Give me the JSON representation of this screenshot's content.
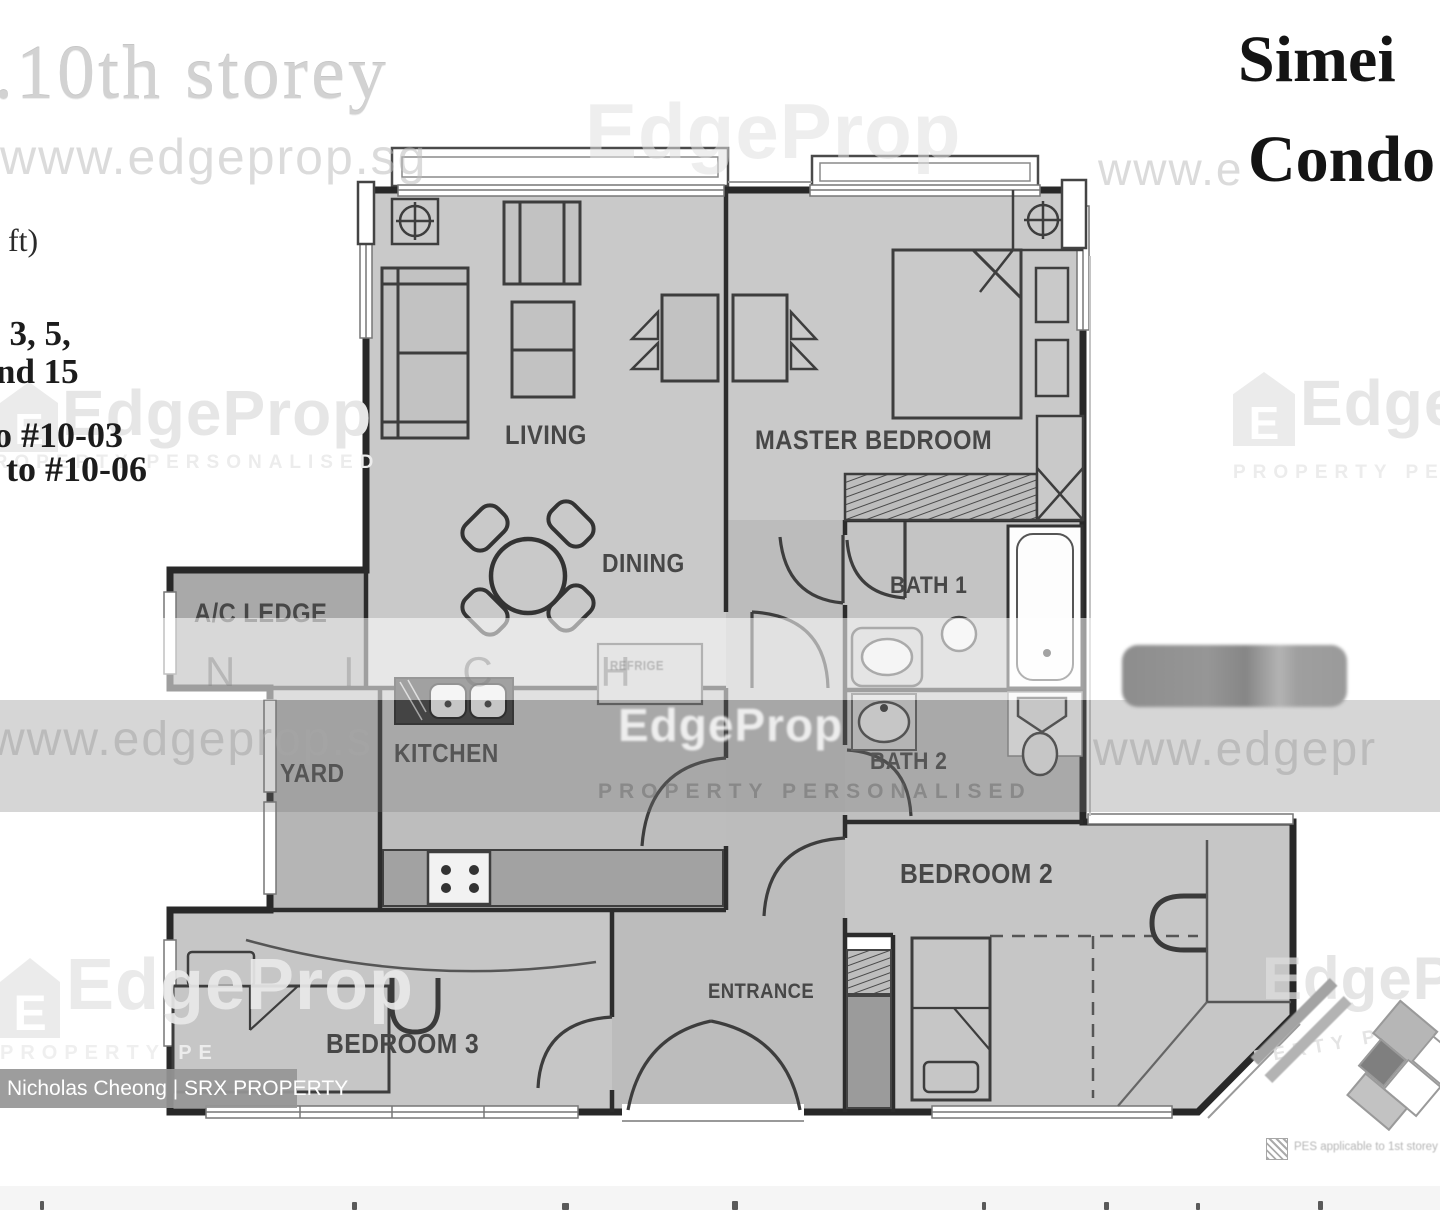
{
  "header": {
    "storey": ".10th storey",
    "project_line1": "Simei",
    "project_line2": "Condo",
    "left_fragments": {
      "sqft": "q ft)",
      "line1": ", 3, 5,",
      "line2": "nd 15",
      "line3": "o #10-03",
      "line4": "to #10-06"
    }
  },
  "rooms": {
    "living": "LIVING",
    "master_bedroom": "MASTER BEDROOM",
    "dining": "DINING",
    "ac_ledge": "A/C LEDGE",
    "yard": "YARD",
    "kitchen": "KITCHEN",
    "bath1": "BATH 1",
    "bath2": "BATH 2",
    "bedroom2": "BEDROOM 2",
    "bedroom3": "BEDROOM 3",
    "entrance": "ENTRANCE",
    "refrigerator": "REFRIGE"
  },
  "watermarks": {
    "url_top_left": "www.edgeprop.sg",
    "url_top_right": "www.e",
    "url_mid_left": "www.edgeprop.s",
    "url_mid_right": "www.edgepr",
    "brand": "EdgeProp",
    "brand_top_center": "EdgeProp",
    "brand_bottom_left": "EdgeProp",
    "brand_bottom_right": "EdgeP",
    "tagline": "PROPERTY PERSONALISED",
    "tagline_bottom_left": "PROPERTY PE",
    "tagline_bottom_right": "PERTY PE",
    "agent_name_spaced": "N I C H",
    "logo_letter": "E"
  },
  "badge": {
    "label": "Nicholas Cheong | SRX PROPERTY"
  },
  "legend": {
    "pes_note": "PES applicable to 1st storey only"
  },
  "colors": {
    "wall": "#282828",
    "room_fill": "#c9c9c9",
    "service_fill": "#a9a9a9",
    "band_gray": "rgba(120,120,120,0.33)"
  }
}
